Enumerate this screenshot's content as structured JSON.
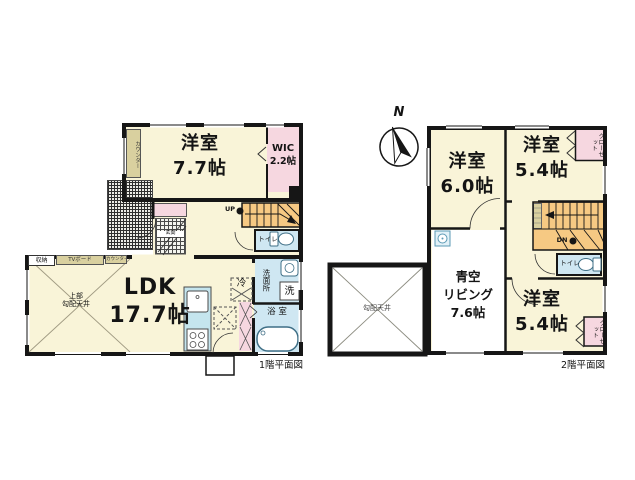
{
  "floor1": {
    "caption": "1階平面図",
    "rooms": {
      "bedroom": {
        "name": "洋室",
        "size": "7.7帖"
      },
      "wic": {
        "name": "WIC",
        "size": "2.2帖"
      },
      "ldk": {
        "name": "LDK",
        "size": "17.7帖"
      },
      "ldk_note_line1": "上部",
      "ldk_note_line2": "勾配天井",
      "entrance": "玄関",
      "toilet": "トイレ",
      "washroom": "洗面所",
      "laundry": "洗",
      "fridge": "冷",
      "bath": "浴 室",
      "storage": "収納",
      "tv_board": "TVボード",
      "counter_wall": "カウンター",
      "counter_kitchen": "カウンター",
      "stairs_up": "UP"
    }
  },
  "floor2": {
    "caption": "2階平面図",
    "north": "N",
    "rooms": {
      "bedroom_a": {
        "name": "洋室",
        "size": "6.0帖"
      },
      "bedroom_b": {
        "name": "洋室",
        "size": "5.4帖"
      },
      "bedroom_c": {
        "name": "洋室",
        "size": "5.4帖"
      },
      "sky_living": {
        "line1": "青空",
        "line2": "リビング",
        "size": "7.6帖"
      },
      "closet_top": "クローゼット",
      "closet_bottom": "クローゼット",
      "sloped_ceiling": "勾配天井",
      "toilet": "トイレ",
      "stairs_dn": "DN"
    }
  },
  "colors": {
    "wall_black": "#161616",
    "room_cream": "#f9f4d8",
    "wet_blue": "#cfe7f2",
    "kitchen_cyan": "#c5e5ee",
    "closet_pink": "#f6d7e0",
    "stairs_orange": "#f6c983",
    "cabinet_beige": "#d9d09f"
  }
}
